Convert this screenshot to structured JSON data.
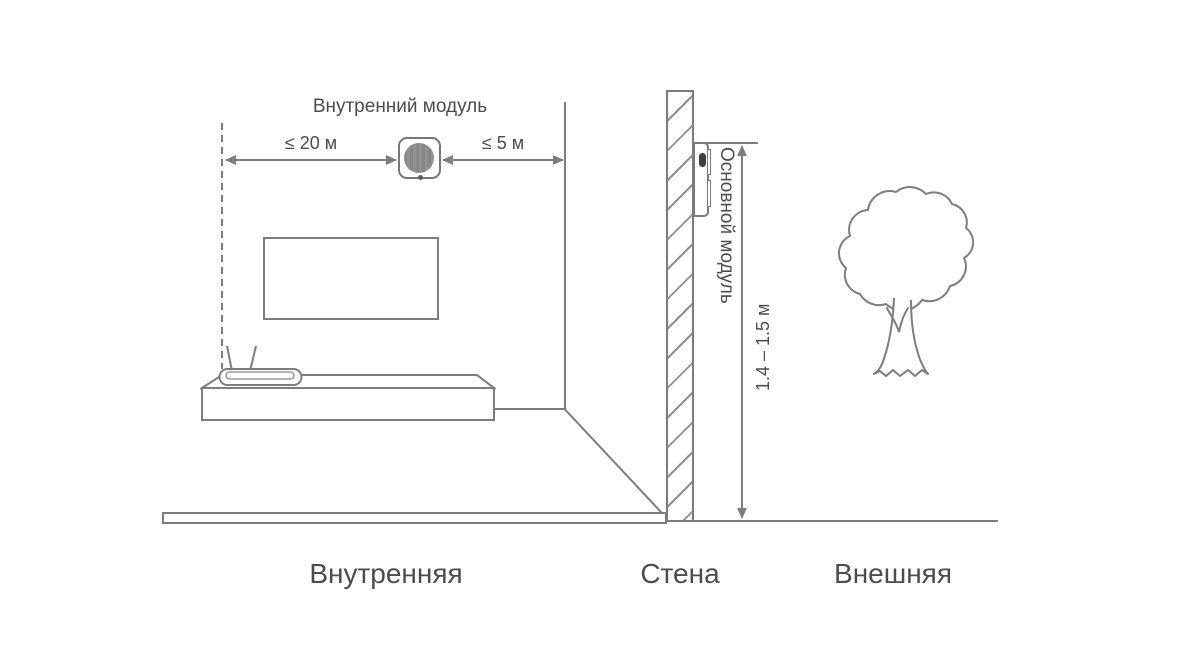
{
  "diagram": {
    "indoor_module_label": "Внутренний модуль",
    "main_module_label": "Основной модуль",
    "measurements": {
      "router_to_indoor_module": "≤ 20 м",
      "indoor_module_to_wall": "≤ 5 м",
      "mount_height_range": "1.4 – 1.5 м"
    },
    "zones": {
      "inner": "Внутренняя",
      "wall": "Стена",
      "outer": "Внешняя"
    },
    "colors": {
      "line": "#7d7d7d",
      "text": "#4c4c4c",
      "module_fill": "#8a8a8a",
      "sensor_dot": "#3f3f3f",
      "background": "#ffffff"
    }
  }
}
